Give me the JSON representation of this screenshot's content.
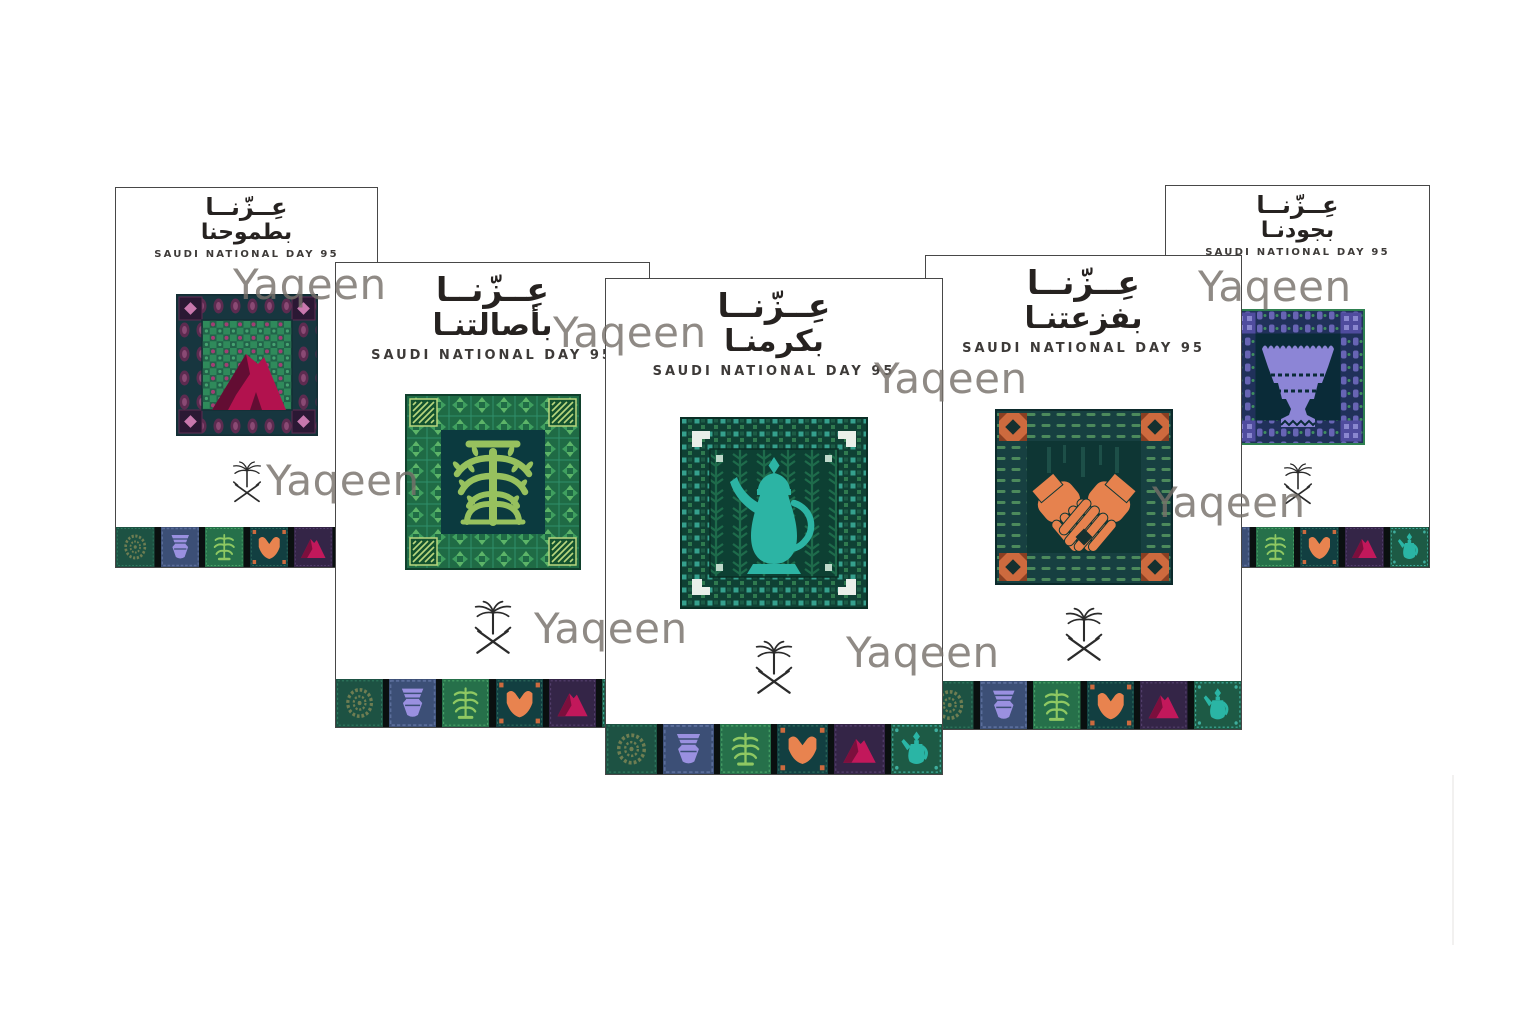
{
  "page": {
    "type": "poster-collage-preview",
    "background": "#ffffff"
  },
  "watermark": {
    "text": "Yaqeen",
    "color": "#7a7572",
    "count": 8
  },
  "emblem": {
    "name": "palm-and-crossed-swords",
    "color": "#2b2b2b"
  },
  "strip_order": [
    "rosette",
    "incense-burner",
    "tree",
    "hands",
    "mountain",
    "dallah"
  ],
  "cards": [
    {
      "position": "far-left",
      "title_line1": "عِــزّنــا",
      "title_line2": "بطموحنا",
      "subtitle": "SAUDI NATIONAL DAY 95",
      "motif": "mountain",
      "accent": "#b2124e"
    },
    {
      "position": "left",
      "title_line1": "عِــزّنــا",
      "title_line2": "بأصالتنـا",
      "subtitle": "SAUDI NATIONAL DAY 95",
      "motif": "tree",
      "accent": "#97c15e"
    },
    {
      "position": "center",
      "title_line1": "عِــزّنــا",
      "title_line2": "بكرمنـا",
      "subtitle": "SAUDI NATIONAL DAY 95",
      "motif": "dallah",
      "accent": "#2cb4a4"
    },
    {
      "position": "right",
      "title_line1": "عِــزّنــا",
      "title_line2": "بفزعتنـا",
      "subtitle": "SAUDI NATIONAL DAY 95",
      "motif": "hands",
      "accent": "#e6824e"
    },
    {
      "position": "far-right",
      "title_line1": "عِــزّنــا",
      "title_line2": "بجودنـا",
      "subtitle": "SAUDI NATIONAL DAY 95",
      "motif": "incense-burner",
      "accent": "#8c85d6"
    }
  ]
}
